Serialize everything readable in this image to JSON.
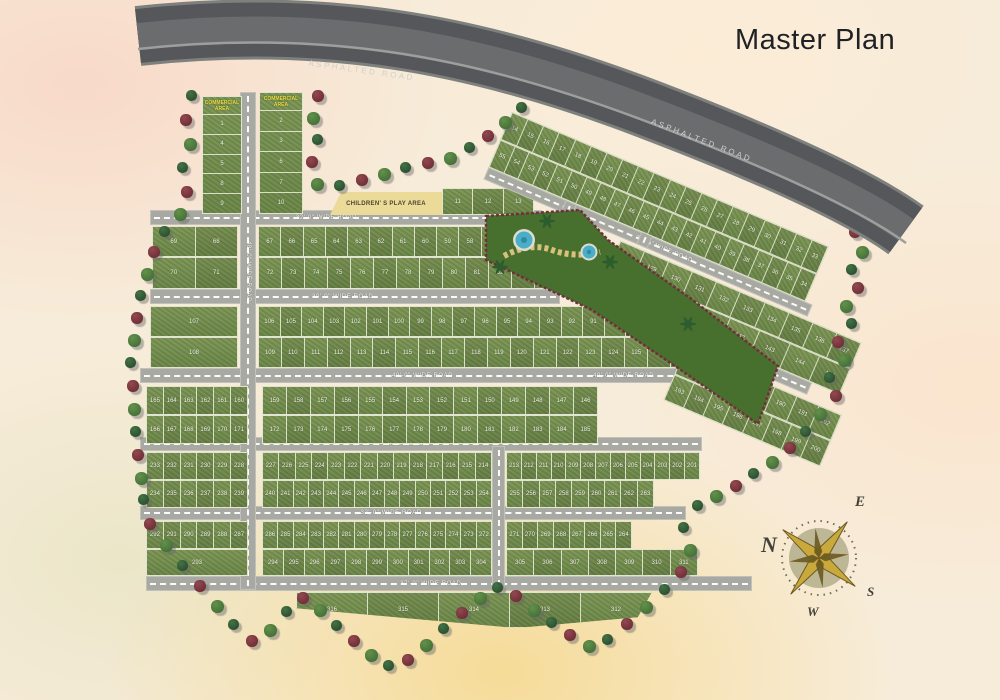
{
  "title": "Master Plan",
  "asphalted_road_label": "ASPHALTED ROAD",
  "roads": {
    "top": "32'-0\" WIDE ROAD",
    "band1": "30'-0\" WIDE ROAD",
    "band2": "40'-0\" WIDE ROAD",
    "band3": "36'-0\" WIDE ROAD",
    "band4": "32'-0\" WIDE ROAD",
    "bottom": "37'-0\" WIDE ROAD",
    "vertical": "48'-0\" WIDE ROAD",
    "vertical2": "30'-0\" WIDE ROAD",
    "ne1": "33'-0\" WIDE ROAD",
    "ne2": "30'-0\" WIDE ROAD"
  },
  "areas": {
    "commercial_left": {
      "label": "COMMERCIAL AREA",
      "plots": [
        "1",
        "4",
        "5",
        "8",
        "9"
      ]
    },
    "commercial_right": {
      "label": "COMMERCIAL AREA",
      "plots": [
        "2",
        "3",
        "6",
        "7",
        "10"
      ]
    },
    "play_area": {
      "label": "CHILDREN' S PLAY AREA",
      "plots": [
        "11",
        "12",
        "13"
      ]
    }
  },
  "rows": {
    "r1a": {
      "range": [
        69,
        68
      ]
    },
    "r1b": {
      "range": [
        70,
        71
      ]
    },
    "r2a": {
      "range": [
        67,
        56
      ]
    },
    "r2b": {
      "range": [
        72,
        88
      ]
    },
    "r3a": {
      "range": [
        107,
        107
      ]
    },
    "r3b": {
      "range": [
        108,
        108
      ]
    },
    "r4a": {
      "range": [
        106,
        89
      ]
    },
    "r4b": {
      "range": [
        109,
        127
      ]
    },
    "r5a": {
      "range": [
        165,
        160
      ]
    },
    "r5b": {
      "range": [
        166,
        171
      ]
    },
    "r6a": {
      "range": [
        159,
        146
      ]
    },
    "r6b": {
      "range": [
        172,
        185
      ]
    },
    "r7a": {
      "range": [
        233,
        228
      ]
    },
    "r7b": {
      "range": [
        234,
        239
      ]
    },
    "r8a": {
      "range": [
        227,
        214
      ]
    },
    "r8b": {
      "range": [
        240,
        254
      ]
    },
    "r9a": {
      "range": [
        213,
        201
      ]
    },
    "r9b": {
      "range": [
        255,
        263
      ]
    },
    "r10a": {
      "range": [
        292,
        287
      ]
    },
    "r10b": {
      "range": [
        293,
        293
      ]
    },
    "r11a": {
      "range": [
        286,
        272
      ]
    },
    "r11b": {
      "range": [
        294,
        304
      ]
    },
    "r12a": {
      "range": [
        271,
        264
      ]
    },
    "r12b": {
      "range": [
        305,
        311
      ]
    },
    "r13": {
      "range": [
        316,
        312
      ]
    }
  },
  "ne_rows": {
    "na": {
      "range": [
        14,
        33
      ]
    },
    "nb": {
      "range": [
        55,
        34
      ]
    },
    "nc": {
      "range": [
        128,
        137
      ]
    },
    "nd": {
      "range": [
        138,
        145
      ]
    },
    "ne": {
      "range": [
        186,
        192
      ]
    },
    "nf": {
      "range": [
        193,
        200
      ]
    }
  },
  "compass": {
    "n": "N",
    "e": "E",
    "s": "S",
    "w": "W"
  },
  "colors": {
    "plot_green": "#74904e",
    "road_gray": "#a9a9a3",
    "asphalt": "#55575a",
    "park_green": "#47702e",
    "park_border_maroon": "#70303a",
    "tree_red": "#77353c",
    "tree_green": "#2f5631",
    "play_area_tan": "#ecda99",
    "commercial_label_yellow": "#e9df45",
    "pond_blue": "#49aec6",
    "background_cream": "#f7ecd9"
  }
}
